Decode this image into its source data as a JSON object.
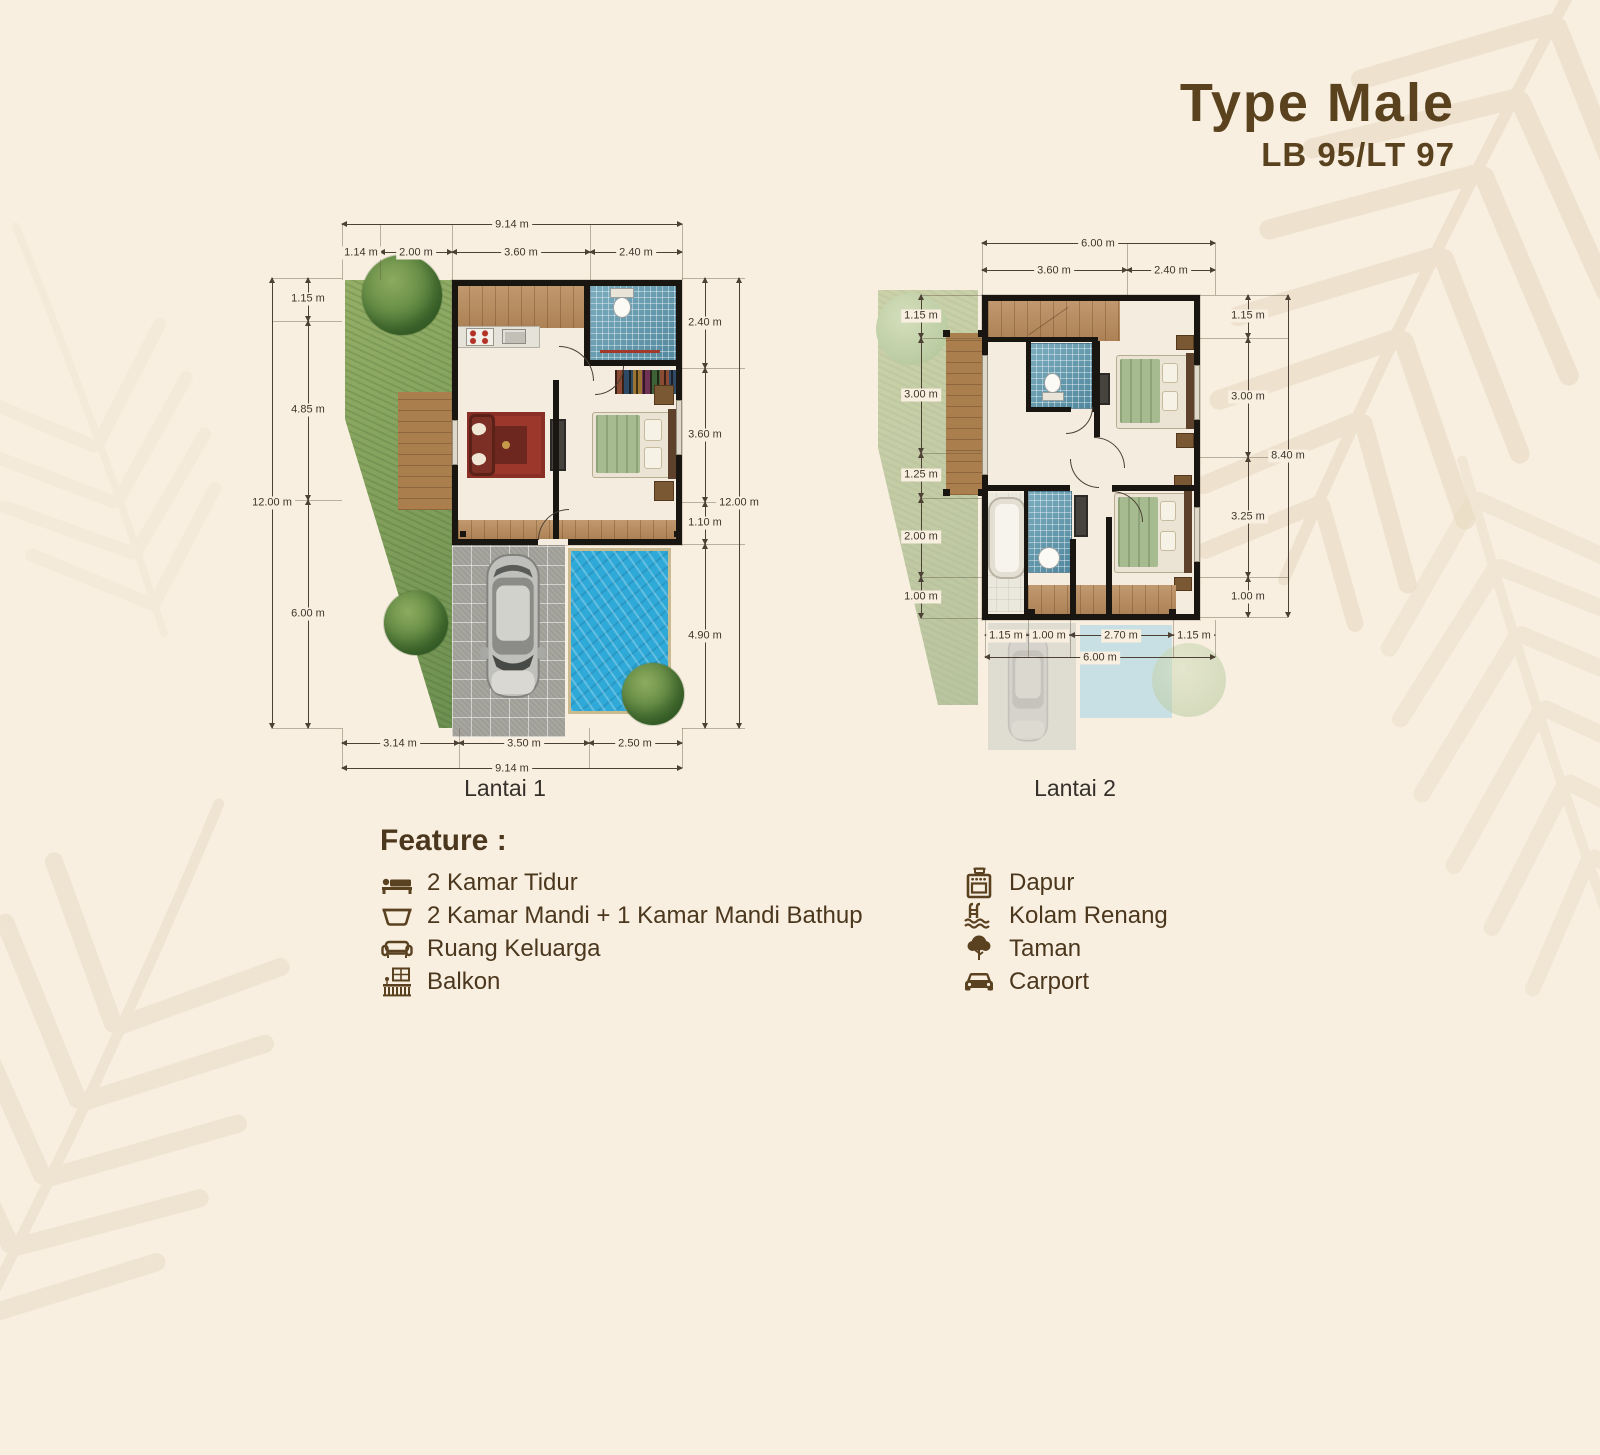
{
  "header": {
    "title": "Type Male",
    "subtitle": "LB 95/LT 97"
  },
  "plan1": {
    "label": "Lantai 1",
    "dims": {
      "top_total": "9.14 m",
      "top": [
        "1.14 m",
        "2.00 m",
        "3.60 m",
        "2.40 m"
      ],
      "left_total": "12.00 m",
      "left": [
        "1.15 m",
        "4.85 m",
        "6.00 m"
      ],
      "right": [
        "2.40 m",
        "3.60 m",
        "1.10 m",
        "4.90 m"
      ],
      "right_total": "12.00 m",
      "bottom": [
        "3.14 m",
        "3.50 m",
        "2.50 m"
      ],
      "bottom_total": "9.14 m"
    }
  },
  "plan2": {
    "label": "Lantai 2",
    "dims": {
      "top_total": "6.00 m",
      "top": [
        "3.60 m",
        "2.40 m"
      ],
      "left": [
        "1.15 m",
        "3.00 m",
        "1.25 m",
        "2.00 m",
        "1.00 m"
      ],
      "right": [
        "1.15 m",
        "3.00 m",
        "3.25 m",
        "1.00 m"
      ],
      "right_total": "8.40 m",
      "bottom": [
        "1.15 m",
        "1.00 m",
        "2.70 m",
        "1.15 m"
      ],
      "bottom_total": "6.00 m"
    }
  },
  "features": {
    "heading": "Feature :",
    "left": [
      {
        "icon": "bed-icon",
        "label": "2 Kamar Tidur"
      },
      {
        "icon": "bathtub-icon",
        "label": "2 Kamar Mandi + 1 Kamar Mandi Bathup"
      },
      {
        "icon": "sofa-icon",
        "label": "Ruang Keluarga"
      },
      {
        "icon": "balcony-icon",
        "label": "Balkon"
      }
    ],
    "right": [
      {
        "icon": "stove-icon",
        "label": "Dapur"
      },
      {
        "icon": "pool-icon",
        "label": "Kolam Renang"
      },
      {
        "icon": "tree-icon",
        "label": "Taman"
      },
      {
        "icon": "car-icon",
        "label": "Carport"
      }
    ]
  },
  "colors": {
    "background": "#f8efe1",
    "title_brown": "#5a421f",
    "text_brown": "#4b371d",
    "wall_black": "#191511",
    "pool_blue": "#2fa9d7",
    "grass_green": "#7fa157",
    "wood_brown": "#ba8c5c",
    "mosaic_blue": "#649fb3",
    "dimension_text": "#3e352a"
  }
}
